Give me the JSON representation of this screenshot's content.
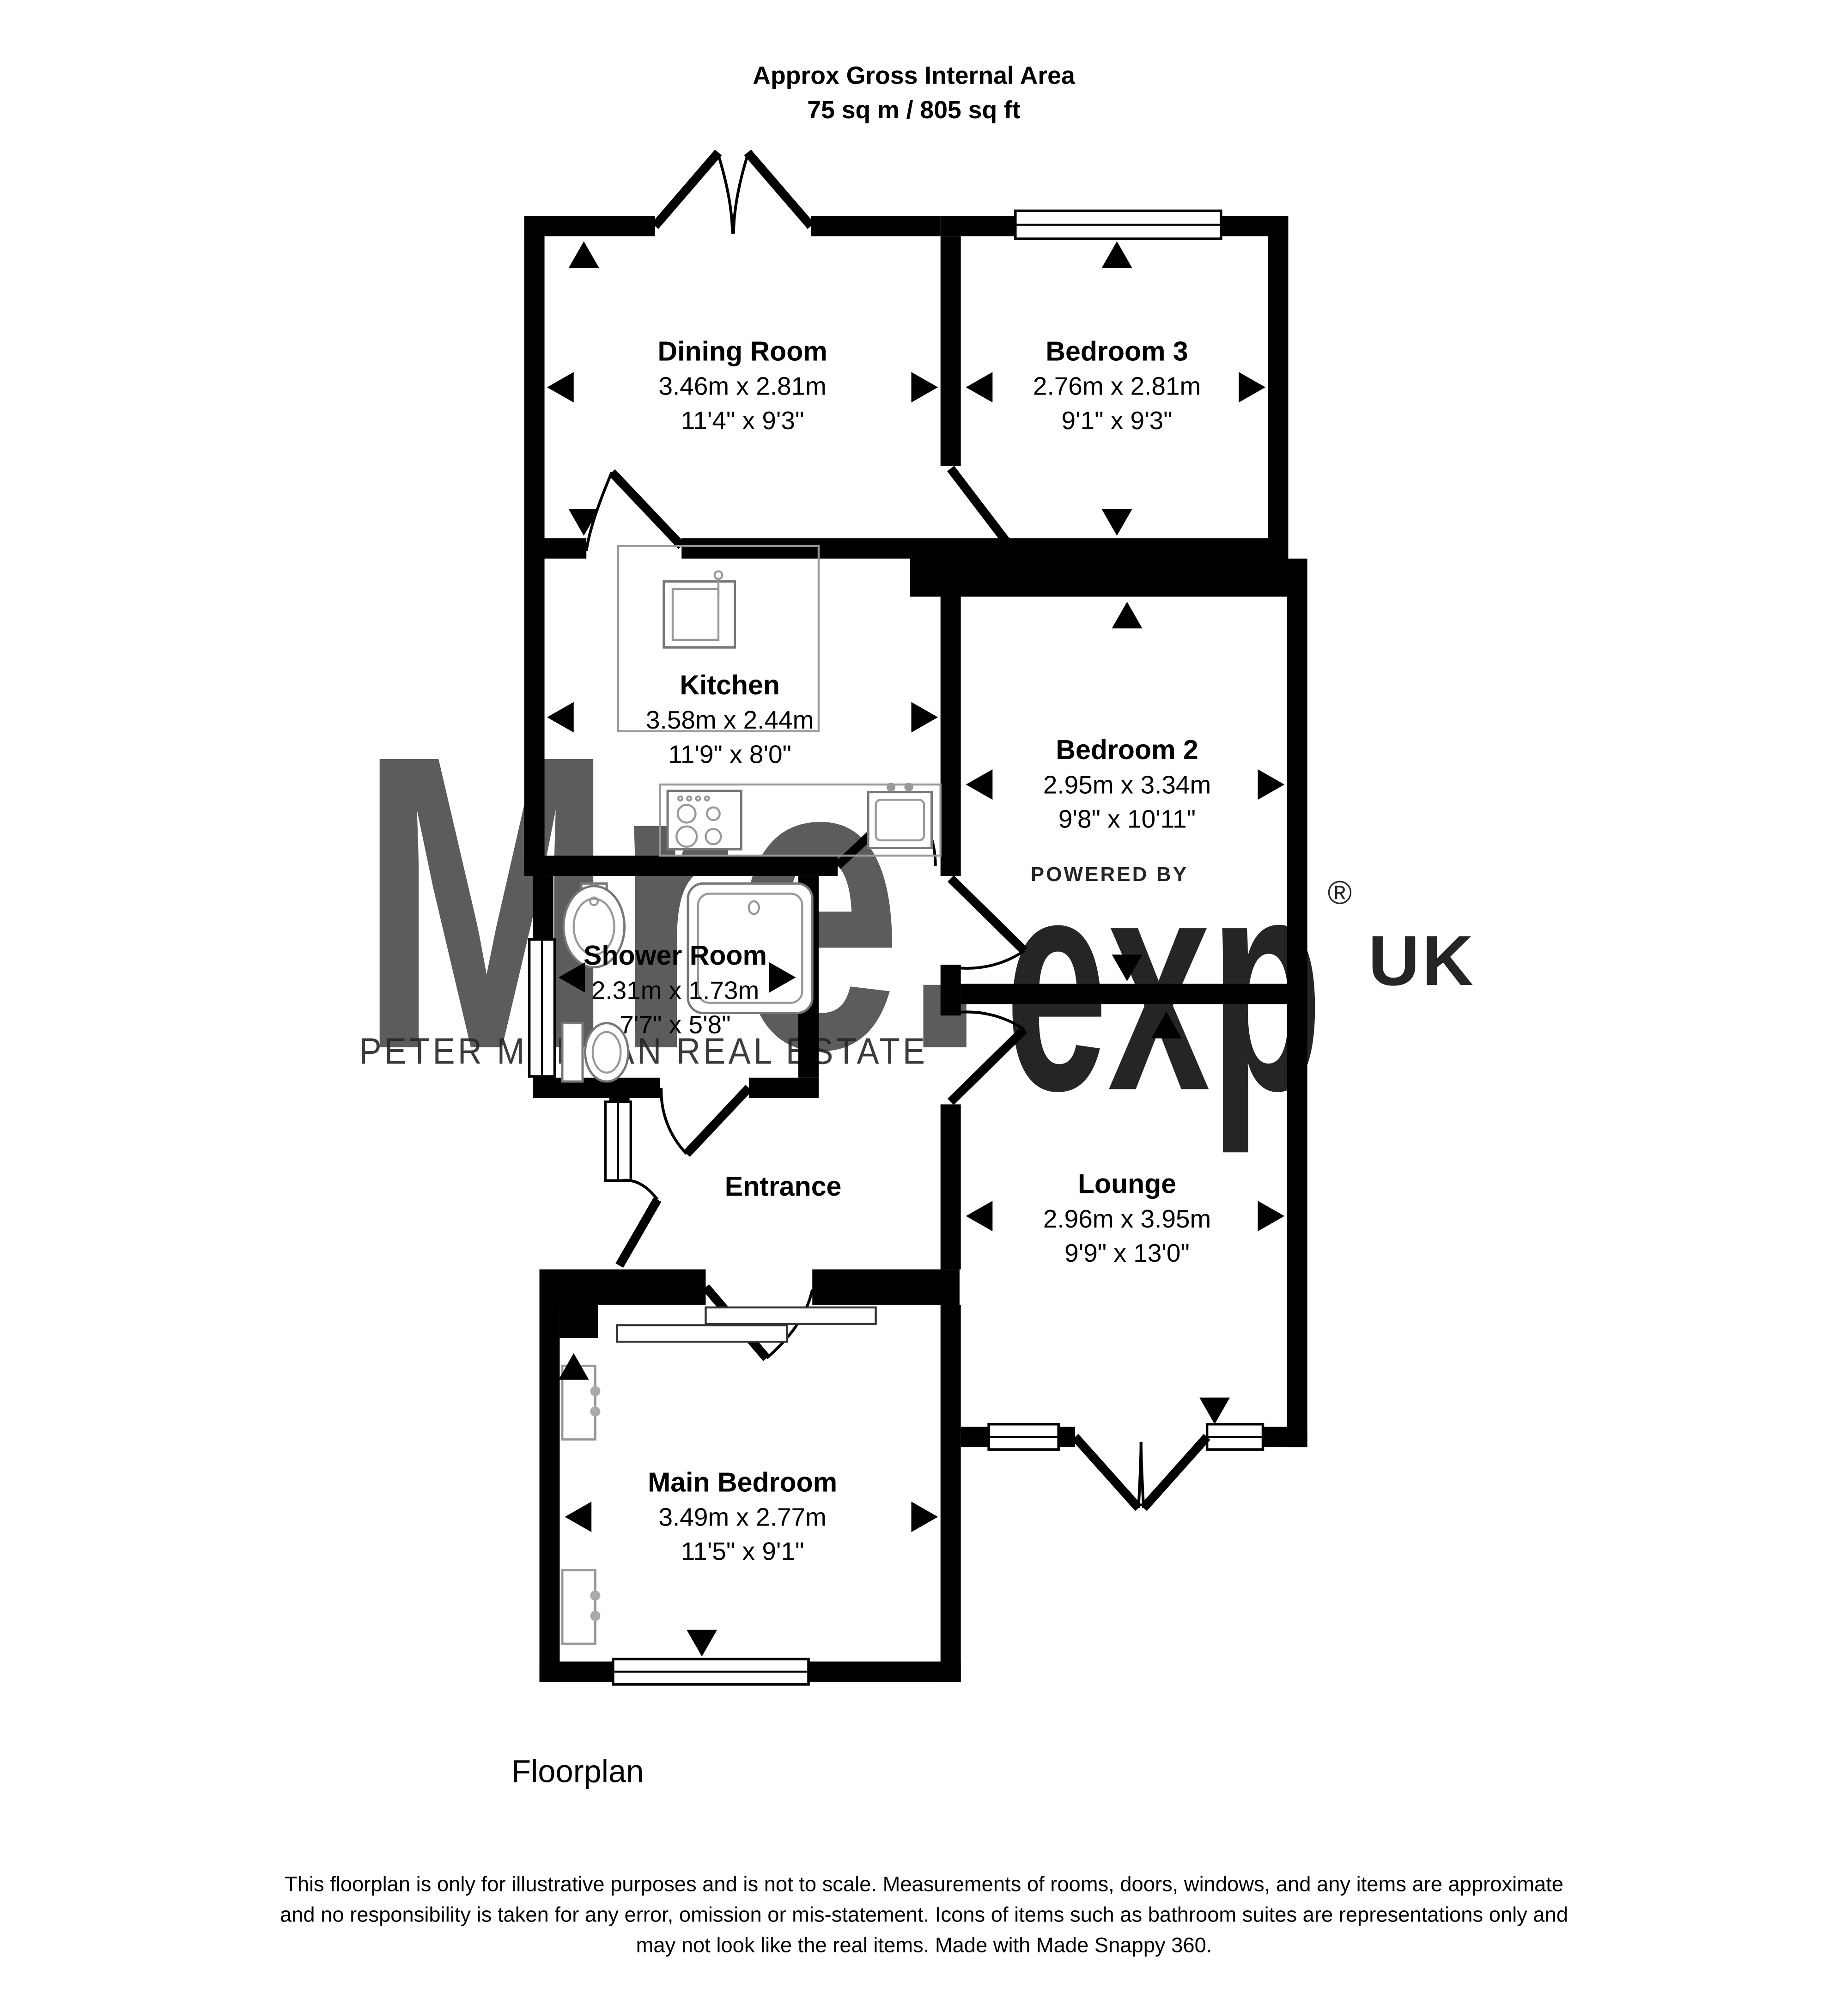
{
  "title": {
    "line1": "Approx Gross Internal Area",
    "line2": "75 sq m / 805 sq ft"
  },
  "rooms": {
    "dining": {
      "name": "Dining Room",
      "metric": "3.46m x 2.81m",
      "imperial": "11'4\" x 9'3\""
    },
    "bedroom3": {
      "name": "Bedroom 3",
      "metric": "2.76m x 2.81m",
      "imperial": "9'1\" x 9'3\""
    },
    "kitchen": {
      "name": "Kitchen",
      "metric": "3.58m x 2.44m",
      "imperial": "11'9\" x 8'0\""
    },
    "bedroom2": {
      "name": "Bedroom 2",
      "metric": "2.95m x 3.34m",
      "imperial": "9'8\" x 10'11\""
    },
    "shower": {
      "name": "Shower Room",
      "metric": "2.31m x 1.73m",
      "imperial": "7'7\" x 5'8\""
    },
    "entrance": {
      "name": "Entrance"
    },
    "lounge": {
      "name": "Lounge",
      "metric": "2.96m x 3.95m",
      "imperial": "9'9\" x 13'0\""
    },
    "main": {
      "name": "Main Bedroom",
      "metric": "3.49m x 2.77m",
      "imperial": "11'5\" x 9'1\""
    }
  },
  "watermark": {
    "brand": "Mre.",
    "tagline": "PETER MORGAN REAL ESTATE",
    "powered_by": "POWERED BY",
    "exp": "exp",
    "registered": "®",
    "uk": "UK",
    "pink": "#f3b8bb",
    "gray": "#d2d2d2"
  },
  "footer": {
    "label": "Floorplan",
    "disclaimer_line1": "This floorplan is only for illustrative purposes and is not to scale. Measurements of rooms, doors, windows, and any items are approximate",
    "disclaimer_line2": "and no responsibility is taken for any error, omission or mis-statement. Icons of items such as bathroom suites are representations only and",
    "disclaimer_line3": "may not look like the real items. Made with Made Snappy 360."
  }
}
